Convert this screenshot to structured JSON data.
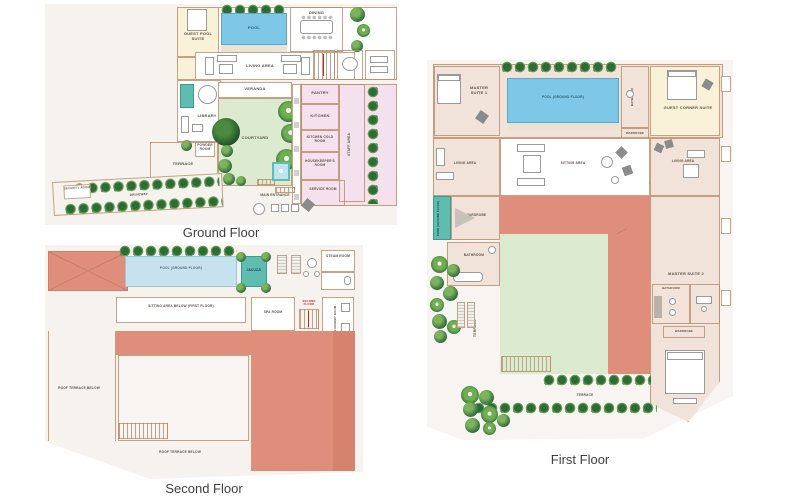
{
  "colors": {
    "plan_background": "#f6f3ef",
    "wall_line": "#c39a7c",
    "cream_room": "#f9f2d8",
    "pink_room": "#f5e0ed",
    "salmon_roof": "#e08e7c",
    "salmon_roof_dark": "#d5826e",
    "pool_blue": "#7ec7e6",
    "pool_pale_blue": "#c6e2ef",
    "water_teal": "#5fbcb1",
    "lawn_green": "#dcead0",
    "tree_dark_green": "#2e6b39",
    "tree_light_green": "#6fae52",
    "label_text": "#5a5248",
    "caption_text": "#3f3f3f",
    "stair_label_red": "#cc2222"
  },
  "ground_floor": {
    "caption": "Ground Floor",
    "labels": {
      "guest_pool_suite": "GUEST POOL SUITE",
      "pool": "POOL",
      "dining": "DINING",
      "living_area": "LIVING AREA",
      "veranda": "VERANDA",
      "library": "LIBRARY",
      "powder_room": "POWDER ROOM",
      "courtyard": "COURTYARD",
      "terrace": "TERRACE",
      "pantry": "PANTRY",
      "kitchen": "KITCHEN",
      "kitchen_cold_room": "KITCHEN COLD ROOM",
      "housekeepers_room": "HOUSEKEEPER'S ROOM",
      "service_room": "SERVICE ROOM",
      "staff_area": "STAFF AREA",
      "driveway": "DRIVEWAY",
      "security_room": "SECURITY ROOM",
      "main_entrance": "MAIN ENTRANCE"
    }
  },
  "second_floor": {
    "caption": "Second Floor",
    "labels": {
      "pool": "POOL (GROUND FLOOR)",
      "jacuzzi": "JACUZZI",
      "steam_room": "STEAM ROOM",
      "sitting_area_below": "SITTING AREA BELOW (FIRST FLOOR)",
      "spa_room": "SPA ROOM",
      "stair": "SECOND FLOOR",
      "laundry_room": "LAUNDRY ROOM",
      "roof_terrace_left": "ROOF TERRACE BELOW",
      "roof_terrace_bottom": "ROOF TERRACE BELOW"
    }
  },
  "first_floor": {
    "caption": "First Floor",
    "labels": {
      "master_suite_1": "MASTER SUITE 1",
      "pool": "POOL (GROUND FLOOR)",
      "bathroom_top": "BATHROOM",
      "guest_corner_suite": "GUEST CORNER SUITE",
      "wardrobe_top": "WARDROBE",
      "living_area_left": "LIVING AREA",
      "sitting_area": "SITTING AREA",
      "stair_second": "SECOND FLOOR",
      "stair_first": "FIRST FLOOR",
      "pond": "POND (GROUND FLOOR)",
      "wardrobe_left": "WARDROBE",
      "bathroom_left": "BATHROOM",
      "living_area_right": "LIVING AREA",
      "master_suite_2": "MASTER SUITE 2",
      "bathroom_right": "BATHROOM",
      "wardrobe_right": "WARDROBE",
      "terrace_side": "TERRACE",
      "terrace_bottom": "TERRACE"
    }
  }
}
